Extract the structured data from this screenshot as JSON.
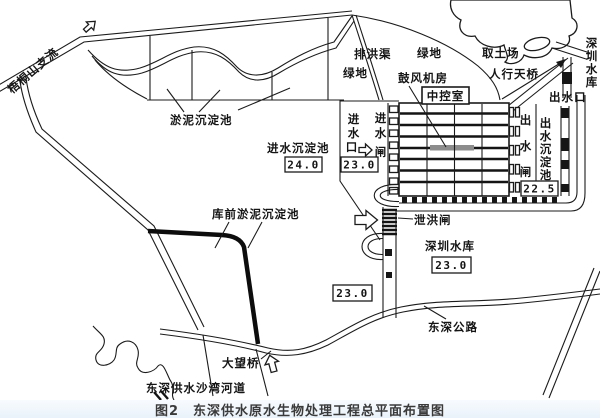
{
  "caption": {
    "text": "图2　东深供水原水生物处理工程总平面布置图"
  },
  "labels": {
    "tributary": "梧桐山支流",
    "silt_pond": "淤泥沉淀池",
    "green_west": "绿地",
    "flood_drain": "排洪渠",
    "green_east": "绿地",
    "borrow_area": "取土场",
    "footbridge": "人行天桥",
    "blower_house": "鼓风机房",
    "control_room": "中控室",
    "inlet_pond": "进水沉淀池",
    "spillway_gate": "泄洪闸",
    "reservoir": "深圳水库",
    "highway": "东深公路",
    "bridge": "大望桥",
    "river": "东深供水沙湾河道",
    "pre_reservoir_pond": "库前淤泥沉淀池",
    "outlet_port": "出水口"
  },
  "vertical_labels": {
    "reservoir_ne": [
      "深",
      "圳",
      "水",
      "库"
    ],
    "intake": [
      "进",
      "水",
      "口"
    ],
    "inlet_gate": [
      "进",
      "水",
      "闸"
    ],
    "outlet_gate": [
      "出",
      "水",
      "闸"
    ],
    "outlet_pond": [
      "出",
      "水",
      "沉",
      "淀",
      "池"
    ]
  },
  "elevations": {
    "inlet_pond": "24.0",
    "intake": "23.0",
    "outlet_pond": "22.5",
    "reservoir": "23.0",
    "spill_channel": "23.0"
  },
  "colors": {
    "ink": "#1b1b1b",
    "caption_bg": "#edf4fb",
    "paper": "#ffffff"
  }
}
